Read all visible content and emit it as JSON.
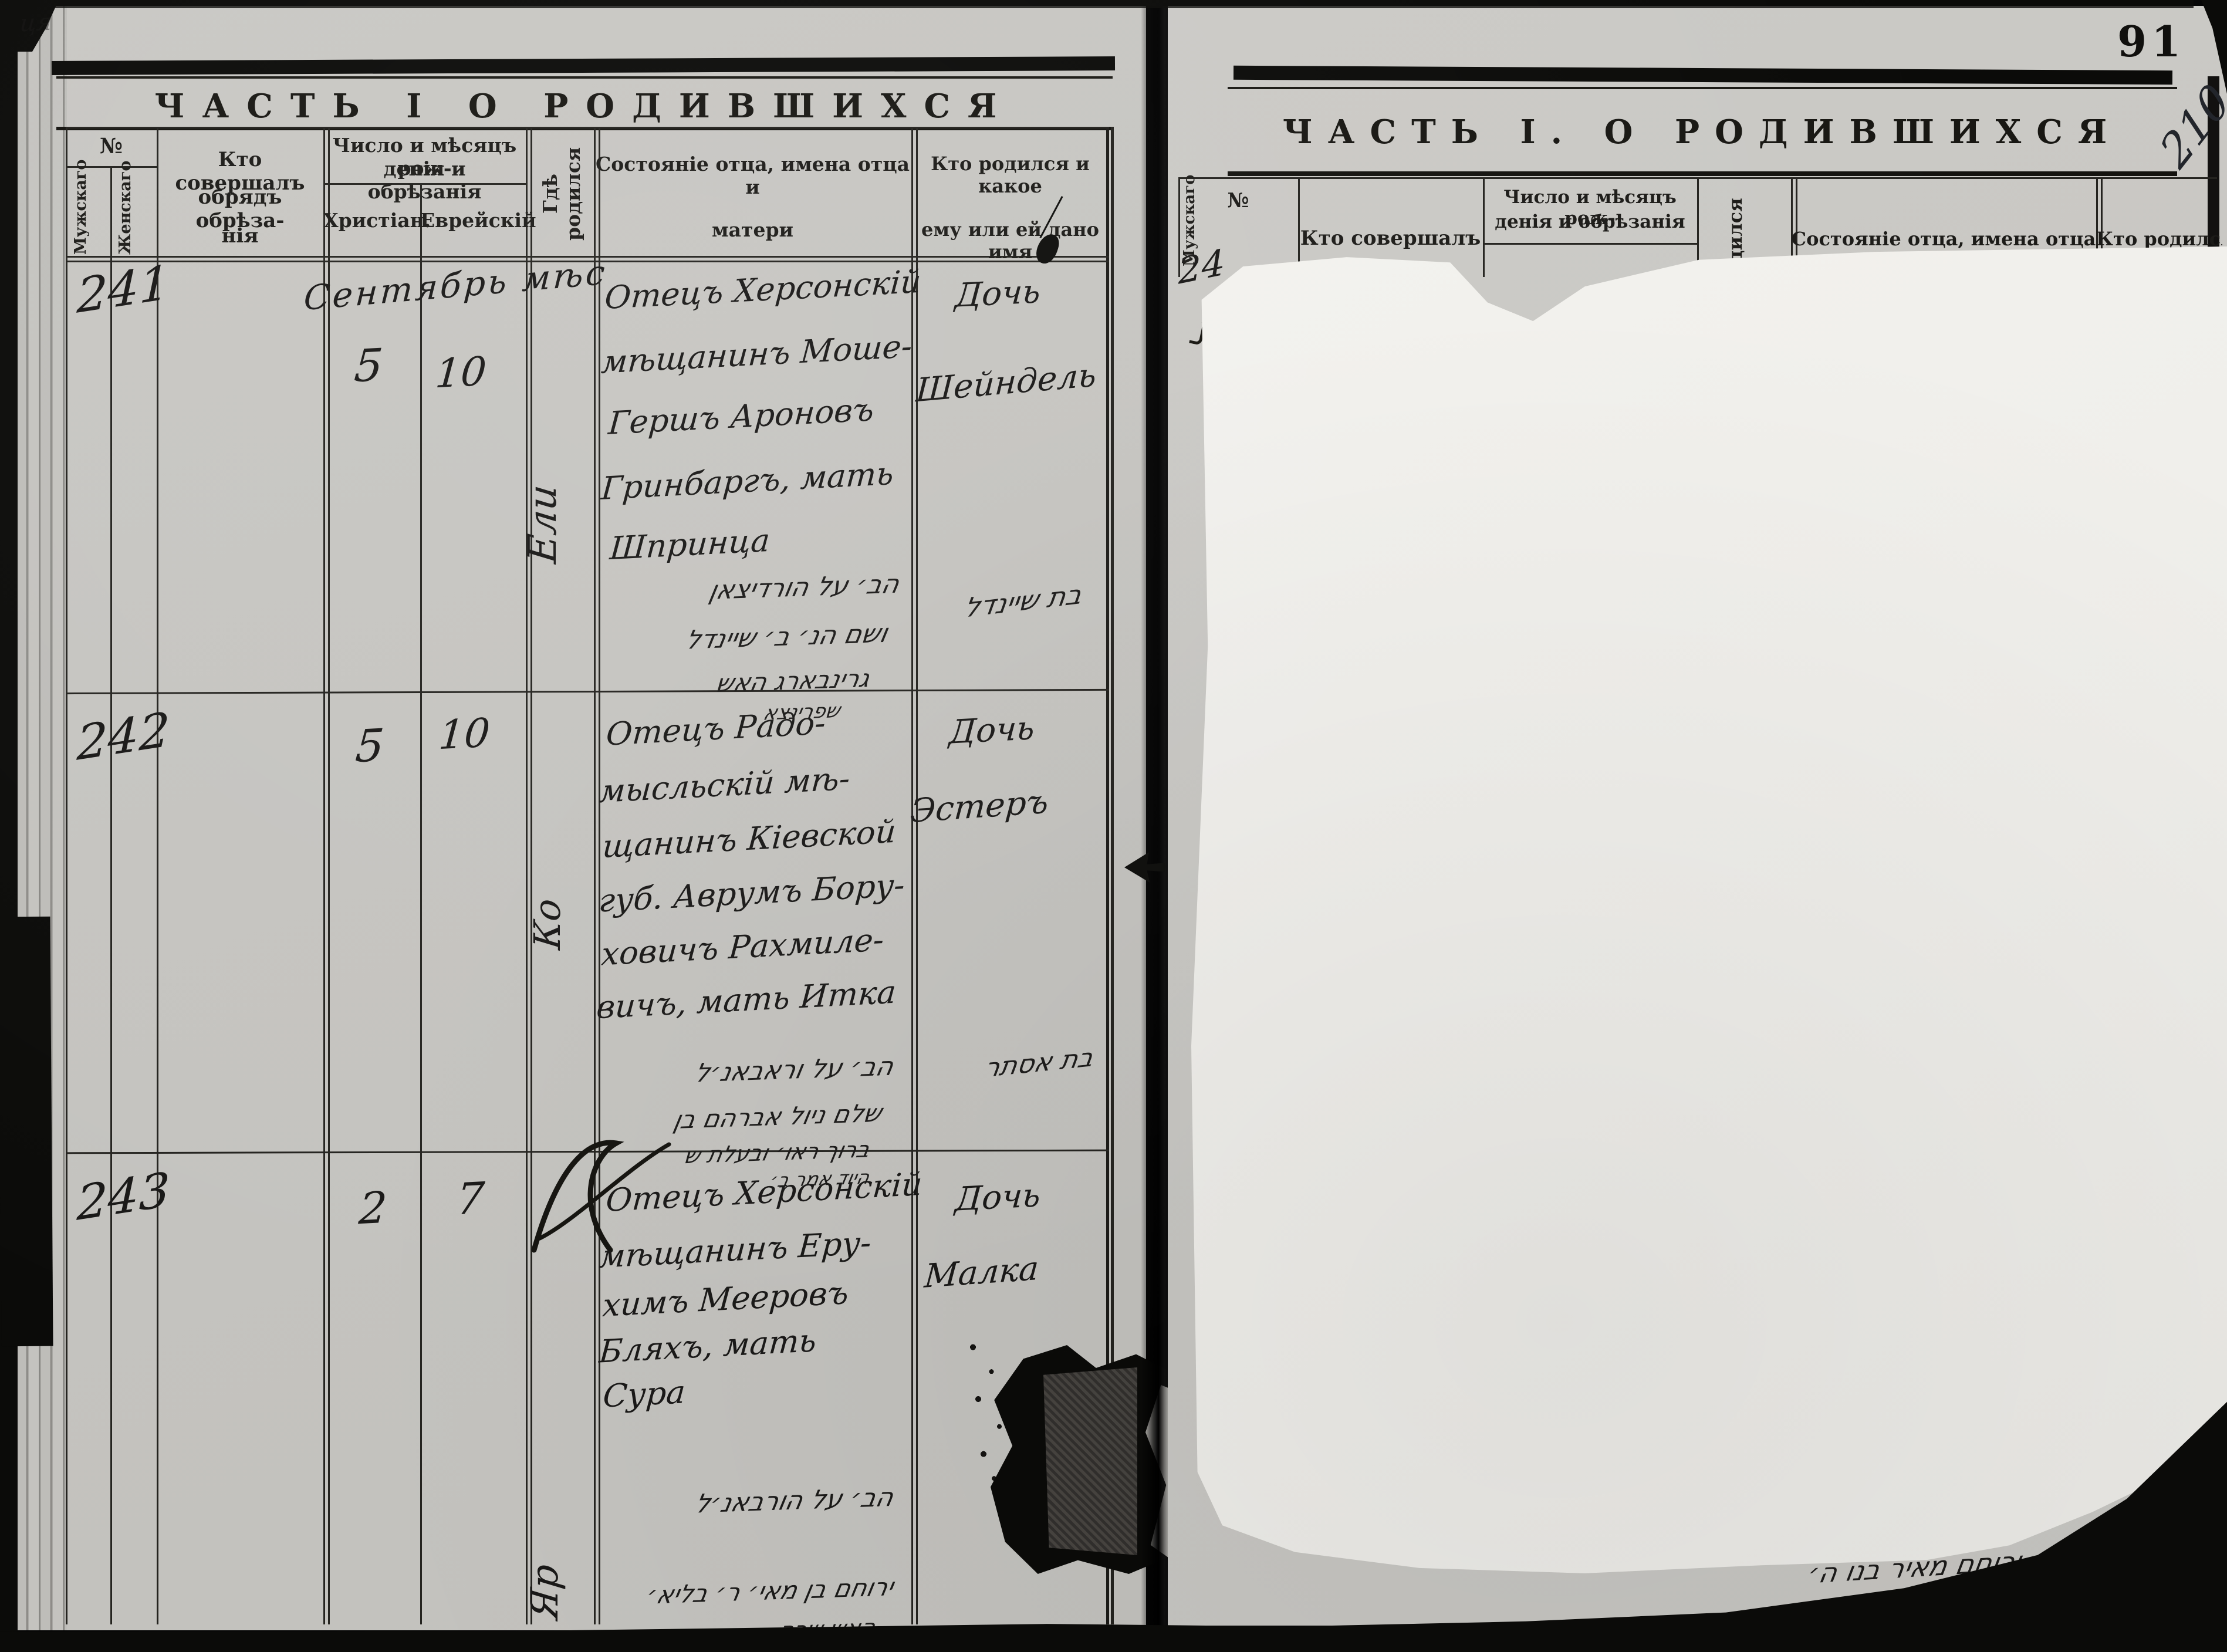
{
  "scan": {
    "folio_number": "91",
    "archival_annotation": "210",
    "top_left_note": "ця"
  },
  "left_page": {
    "title": "ЧАСТЬ I О РОДИВШИХСЯ",
    "headers": {
      "no": "№",
      "male": "Мужскаго",
      "female": "Женскаго",
      "officiant_l1": "Кто совершалъ",
      "officiant_l2": "обрядъ обрѣза-",
      "officiant_l3": "нія",
      "date_l1": "Число и мѣсяцъ рож-",
      "date_l2": "денія и обрѣзанія",
      "christian": "Христіан.",
      "jewish": "Еврейскій",
      "birthplace": "Гдѣ родился",
      "father_l1": "Состояніе отца, имена отца и",
      "father_l2": "матери",
      "child_l1": "Кто родился и какое",
      "child_l2": "ему или ей дано имя"
    },
    "records": [
      {
        "no": "241",
        "month_note": "Сентябрь мѣс",
        "christian_day": "5",
        "jewish_day": "10",
        "birthplace": "Ели",
        "father_l1": "Отецъ Херсонскій",
        "father_l2": "мѣщанинъ Моше-",
        "father_l3": "Гершъ Ароновъ",
        "father_l4": "Гринбаргъ, мать",
        "father_l5": "Шпринца",
        "child_l1": "Дочь",
        "child_l2": "Шейндель",
        "heb_l1": "הב׳ על הורדיצאן",
        "heb_l2": "ושם הנ׳ ב׳ שיינדל",
        "heb_l3": "גרינבארג האש",
        "heb_l4": "שפרינצא",
        "heb_name": "בת שיינדל"
      },
      {
        "no": "242",
        "christian_day": "5",
        "jewish_day": "10",
        "birthplace": "Ко",
        "father_l1": "Отецъ Радо-",
        "father_l2": "мысльскій мѣ-",
        "father_l3": "щанинъ Кіевской",
        "father_l4": "губ. Аврумъ Бору-",
        "father_l5": "ховичъ Рахмиле-",
        "father_l6": "вичъ, мать Итка",
        "child_l1": "Дочь",
        "child_l2": "Эстеръ",
        "heb_l1": "הב׳ על וראבאנ׳ל",
        "heb_l2": "שלם ניול אברהם בן",
        "heb_l3": "ברוך ראו׳ ובעלת ש",
        "heb_l4": "היוד אמר ב׳",
        "heb_name": "בת אסתר"
      },
      {
        "no": "243",
        "christian_day": "2",
        "jewish_day": "7",
        "birthplace": "Яр",
        "father_l1": "Отецъ Херсонскій",
        "father_l2": "мѣщанинъ Еру-",
        "father_l3": "химъ Мееровъ",
        "father_l4": "Бляхъ, мать",
        "father_l5": "Сура",
        "child_l1": "Дочь",
        "child_l2": "Малка",
        "heb_l1": "הב׳ על הורבאנ׳ל",
        "heb_l2": "ירוחם בן מאי׳ ר׳ בליא׳",
        "heb_l3": "האש שרה",
        "heb_name": "ב׳"
      }
    ]
  },
  "right_page": {
    "title": "ЧАСТЬ I. О РОДИВШИХСЯ",
    "headers": {
      "no": "№",
      "officiant_l1": "Кто совершалъ",
      "date_l1": "Число и мѣсяцъ рож-",
      "date_l2": "денія и обрѣзанія",
      "birthplace_partial": "дился",
      "father_l1": "Состояніе отца, имена отца и",
      "child_l1": "Кто родился и какое"
    },
    "male_partial": "Мужскаго",
    "record_no_partial": "24",
    "bottom_hebrew": "ירוחם מאיר בנו ה׳"
  }
}
